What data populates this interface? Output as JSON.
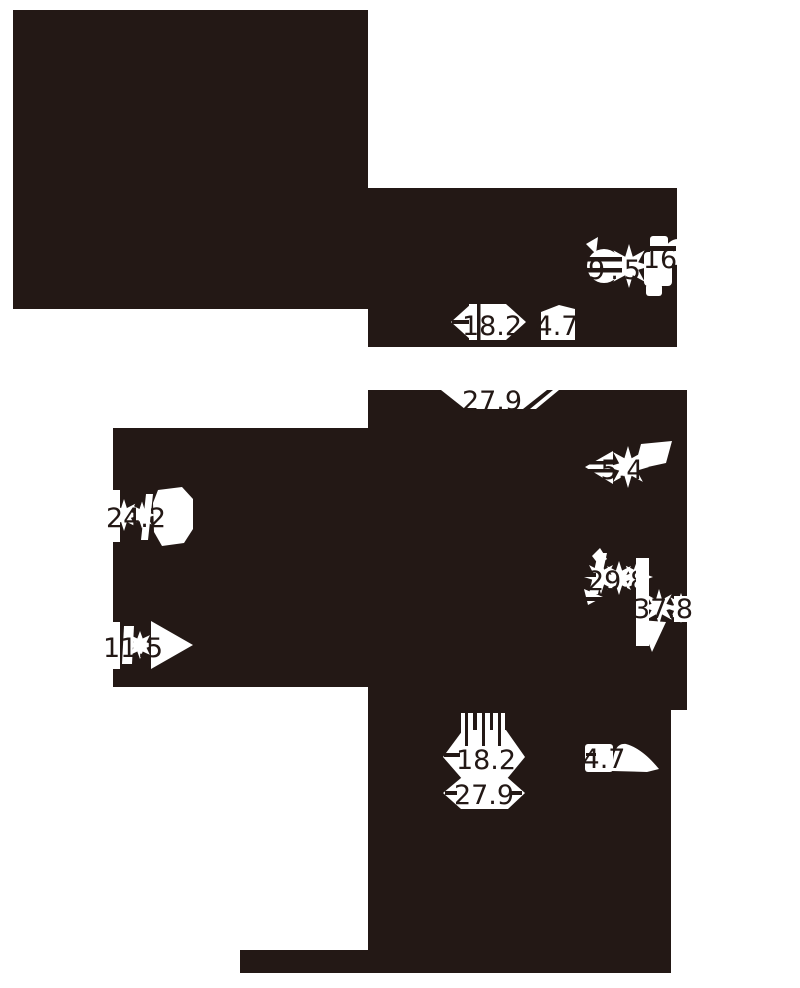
{
  "figure": {
    "title": "Inverted engineering drawing fragment with dimension callouts",
    "ink_color": "#231815",
    "background_color": "#ffffff"
  },
  "dims": {
    "d95": {
      "value": "9.5"
    },
    "d16": {
      "value": "16"
    },
    "d182t": {
      "value": "18.2"
    },
    "d47t": {
      "value": "4.7"
    },
    "d279t": {
      "value": "27.9"
    },
    "d54": {
      "value": "5.4"
    },
    "d298": {
      "value": "29.8"
    },
    "d378": {
      "value": "37.8"
    },
    "d242": {
      "value": "24.2"
    },
    "d115": {
      "value": "11.5"
    },
    "d182b": {
      "value": "18.2"
    },
    "d279b": {
      "value": "27.9"
    },
    "d47b": {
      "value": "4.7"
    }
  }
}
